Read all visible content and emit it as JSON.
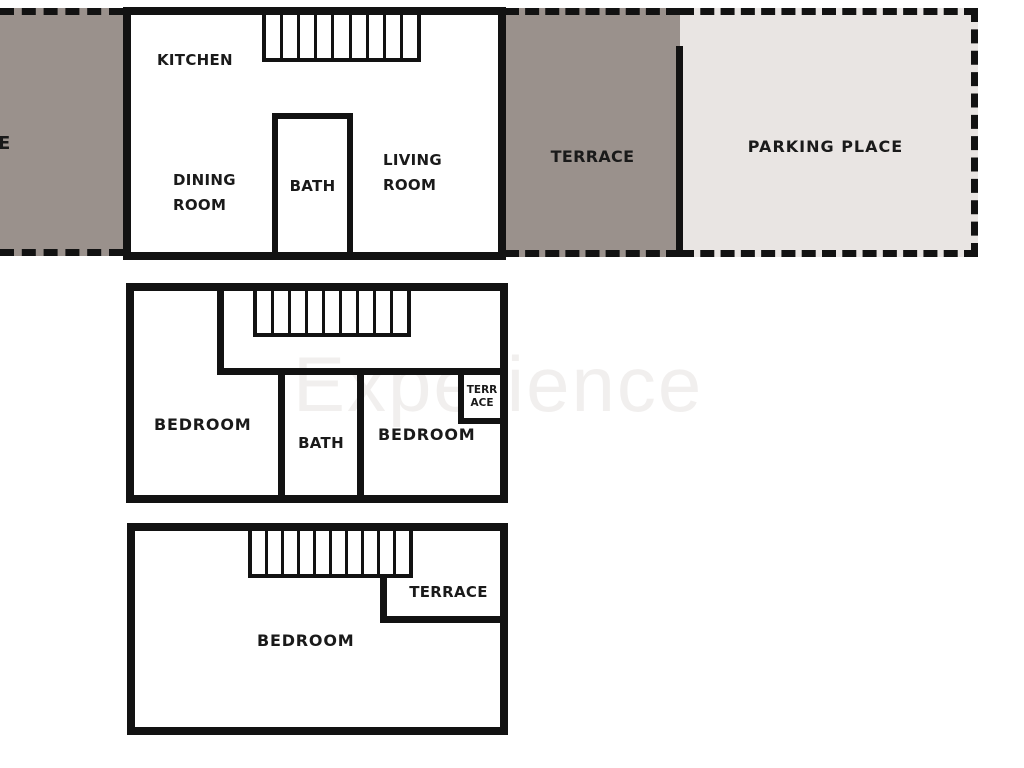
{
  "colors": {
    "wall": "#121212",
    "terrace_fill": "#9a918c",
    "parking_fill": "#e9e5e3",
    "watermark": "#f1efee",
    "text": "#1a1a1a"
  },
  "watermark": "Experience",
  "outdoor": {
    "left_strip_cut_label": "E",
    "terrace": "TERRACE",
    "parking": "PARKING PLACE"
  },
  "floor_top": {
    "stairs_treads": 9,
    "kitchen": "KITCHEN",
    "dining": "DINING ROOM",
    "bath": "BATH",
    "living": "LIVING ROOM"
  },
  "floor_middle": {
    "stairs_treads": 9,
    "bedroom_left": "BEDROOM",
    "bath": "BATH",
    "bedroom_right": "BEDROOM",
    "terrace_lines": [
      "TERR",
      "ACE"
    ]
  },
  "floor_bottom": {
    "stairs_treads": 10,
    "terrace": "TERRACE",
    "bedroom": "BEDROOM"
  }
}
